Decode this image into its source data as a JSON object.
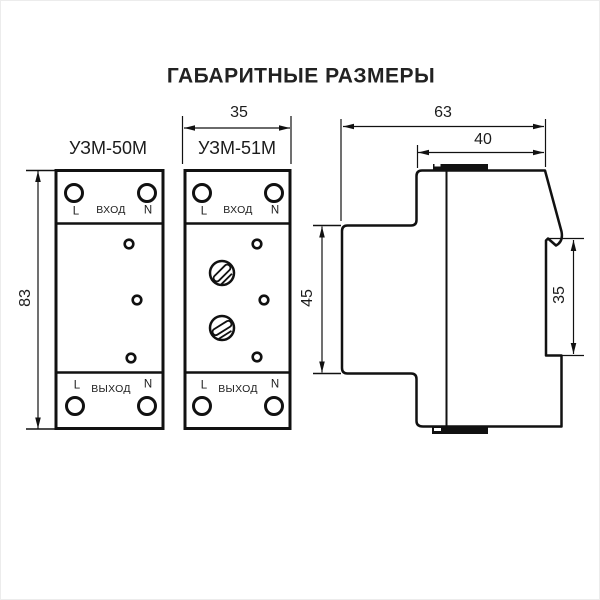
{
  "title": "ГАБАРИТНЫЕ РАЗМЕРЫ",
  "front_view": {
    "device1": {
      "model": "УЗМ-50М",
      "input": {
        "l": "L",
        "label": "ВХОД",
        "n": "N"
      },
      "output": {
        "l": "L",
        "label": "ВЫХОД",
        "n": "N"
      }
    },
    "device2": {
      "model": "УЗМ-51М",
      "input": {
        "l": "L",
        "label": "ВХОД",
        "n": "N"
      },
      "output": {
        "l": "L",
        "label": "ВЫХОД",
        "n": "N"
      }
    }
  },
  "dimensions_mm": {
    "width": "35",
    "height": "83",
    "depth": "63",
    "depth_behind_front": "40",
    "front_panel_height": "45",
    "din_recess": "35"
  },
  "colors": {
    "line": "#111111",
    "text": "#1c1c1c",
    "background": "#ffffff"
  }
}
